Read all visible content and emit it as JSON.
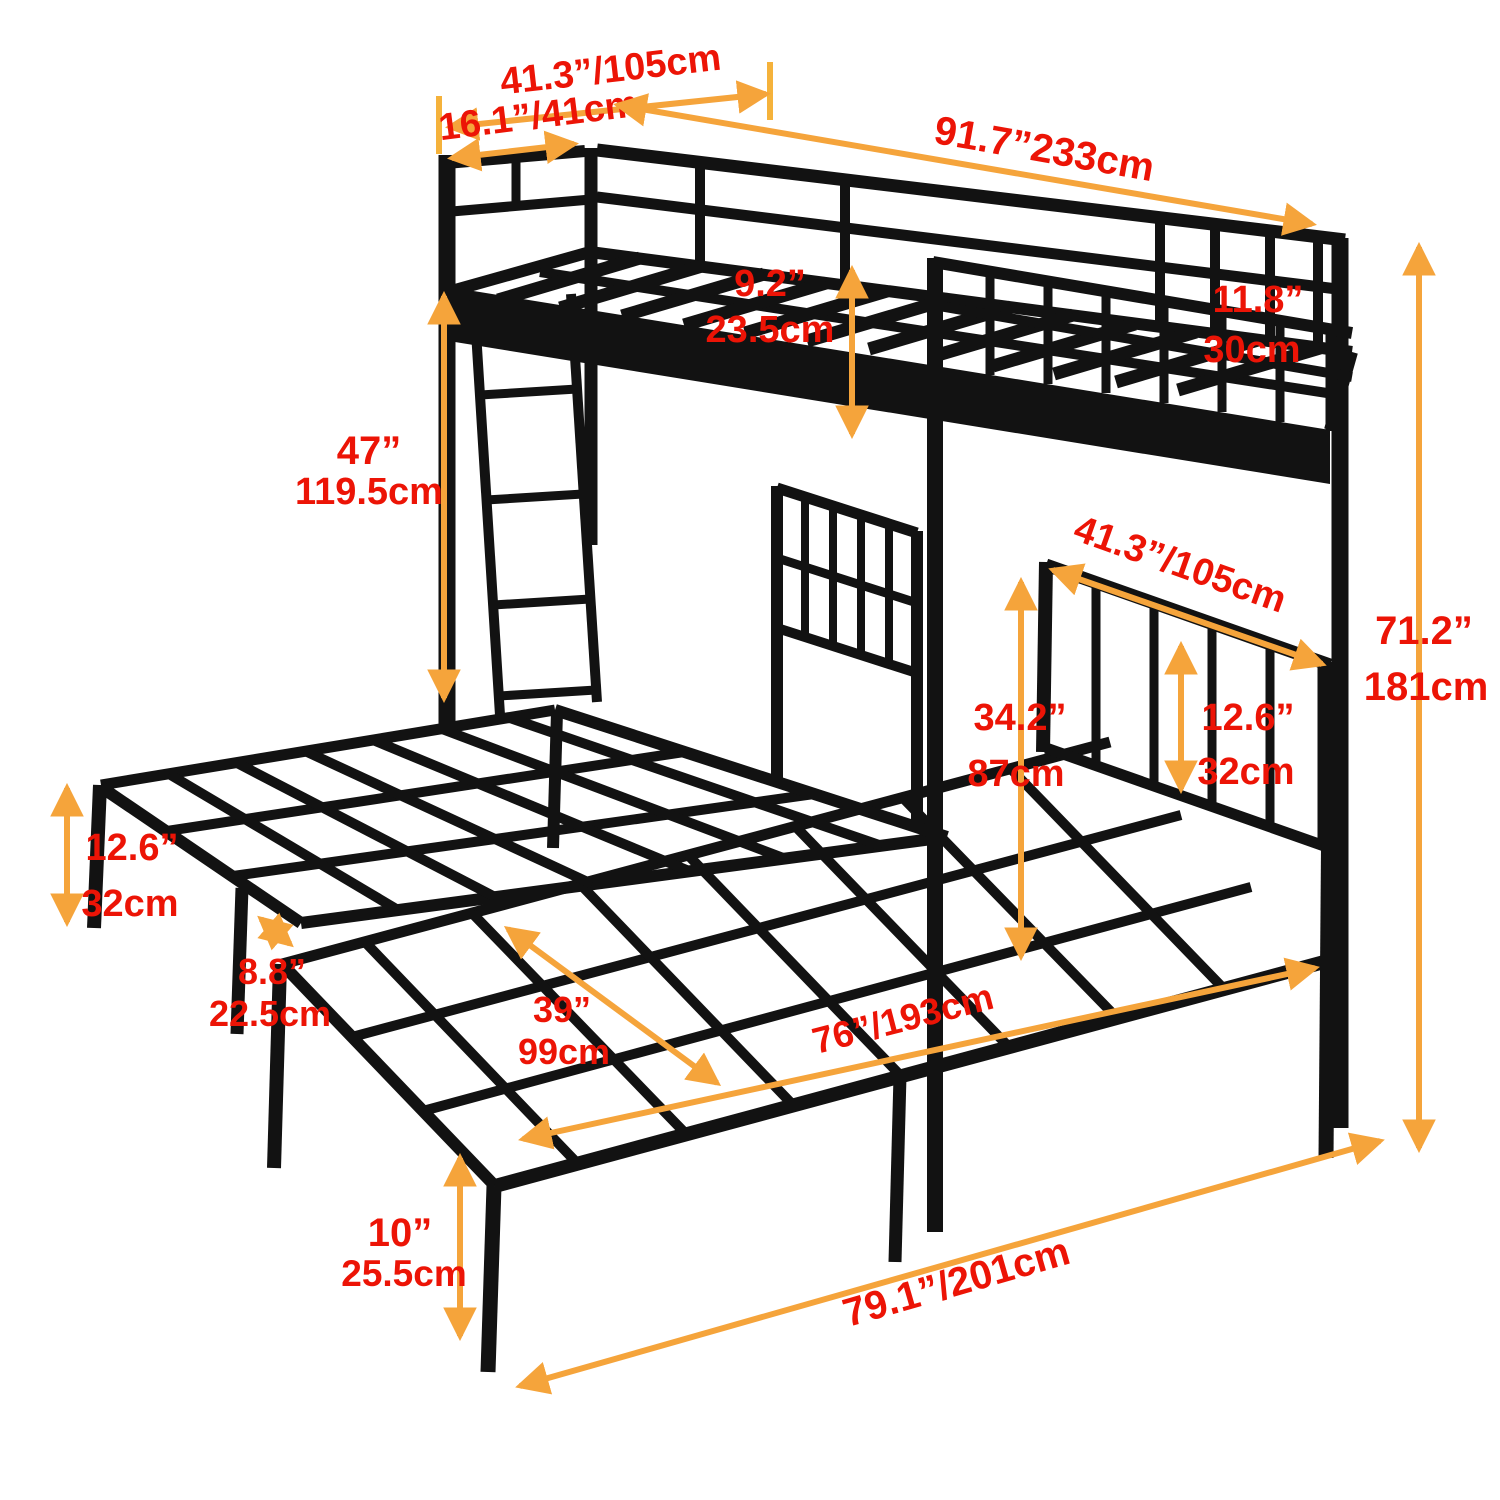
{
  "diagram": {
    "type": "product-dimension-diagram",
    "subject": "metal triple bunk bed with two lower platform beds, ladder and guardrails"
  },
  "colors": {
    "frame": "#121212",
    "dimension_line": "#f5a43b",
    "dimension_label": "#ec1406",
    "background": "#ffffff"
  },
  "dimensions": {
    "upper_bed_width": {
      "label": "41.3”/105cm"
    },
    "upper_head_guard_width": {
      "label": "16.1”/41cm"
    },
    "upper_total_length": {
      "label": "91.7”233cm"
    },
    "upper_frame_thickness": {
      "inches": "9.2”",
      "cm": "23.5cm"
    },
    "upper_guardrail_height": {
      "inches": "11.8”",
      "cm": "30cm"
    },
    "under_bunk_clearance": {
      "inches": "47”",
      "cm": "119.5cm"
    },
    "overall_height": {
      "inches": "71.2”",
      "cm": "181cm"
    },
    "headboard_width": {
      "label": "41.3”/105cm"
    },
    "headboard_height": {
      "inches": "34.2”",
      "cm": "87cm"
    },
    "headboard_top_section": {
      "inches": "12.6”",
      "cm": "32cm"
    },
    "platform_height": {
      "inches": "12.6”",
      "cm": "32cm"
    },
    "gap_between_beds": {
      "inches": "8.8”",
      "cm": "22.5cm"
    },
    "lower_bed_width": {
      "inches": "39”",
      "cm": "99cm"
    },
    "lower_bed_length": {
      "label": "76”/193cm"
    },
    "leg_height": {
      "inches": "10”",
      "cm": "25.5cm"
    },
    "overall_floor_length": {
      "label": "79.1”/201cm"
    }
  }
}
